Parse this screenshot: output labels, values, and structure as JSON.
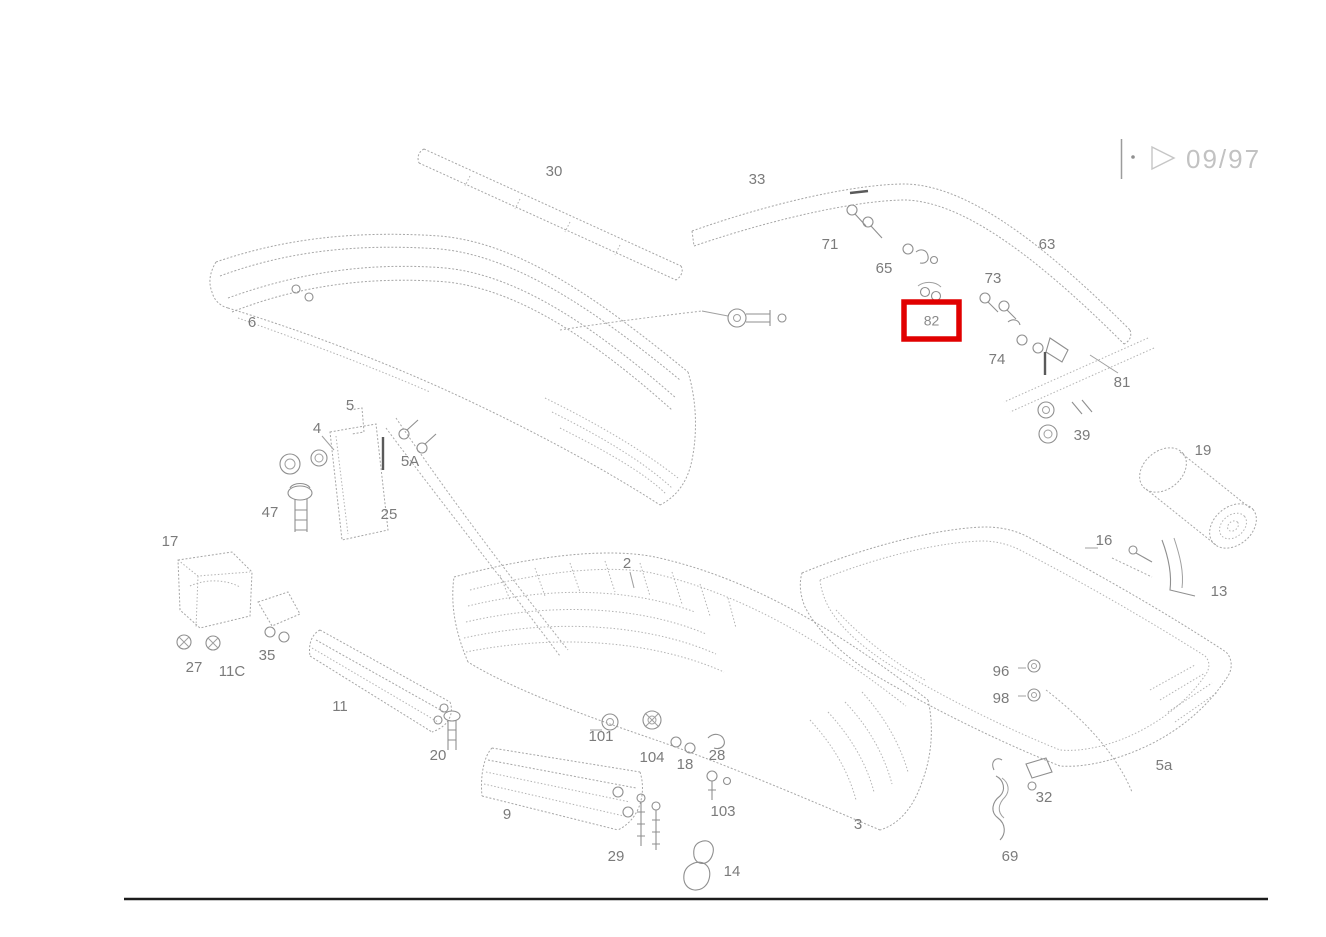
{
  "header": {
    "dot": "·",
    "revision": "09/97"
  },
  "highlight_box": {
    "label": "82",
    "x": 904,
    "y": 302,
    "width": 55,
    "height": 37,
    "color": "#e10000"
  },
  "diagram": {
    "description": "Exploded parts diagram of rear bumper assembly with numbered callouts",
    "labels": [
      {
        "text": "30",
        "x": 554,
        "y": 176
      },
      {
        "text": "33",
        "x": 757,
        "y": 184
      },
      {
        "text": "71",
        "x": 830,
        "y": 249
      },
      {
        "text": "65",
        "x": 884,
        "y": 273
      },
      {
        "text": "63",
        "x": 1047,
        "y": 249
      },
      {
        "text": "73",
        "x": 993,
        "y": 283
      },
      {
        "text": "74",
        "x": 997,
        "y": 364
      },
      {
        "text": "81",
        "x": 1122,
        "y": 387
      },
      {
        "text": "39",
        "x": 1082,
        "y": 440
      },
      {
        "text": "19",
        "x": 1203,
        "y": 455
      },
      {
        "text": "16",
        "x": 1104,
        "y": 545
      },
      {
        "text": "13",
        "x": 1219,
        "y": 596
      },
      {
        "text": "6",
        "x": 252,
        "y": 327
      },
      {
        "text": "4",
        "x": 317,
        "y": 433
      },
      {
        "text": "5",
        "x": 350,
        "y": 410
      },
      {
        "text": "5A",
        "x": 410,
        "y": 466
      },
      {
        "text": "47",
        "x": 270,
        "y": 517
      },
      {
        "text": "25",
        "x": 389,
        "y": 519
      },
      {
        "text": "17",
        "x": 170,
        "y": 546
      },
      {
        "text": "27",
        "x": 194,
        "y": 672
      },
      {
        "text": "11C",
        "x": 232,
        "y": 676
      },
      {
        "text": "35",
        "x": 267,
        "y": 660
      },
      {
        "text": "11",
        "x": 340,
        "y": 711
      },
      {
        "text": "20",
        "x": 438,
        "y": 760
      },
      {
        "text": "2",
        "x": 627,
        "y": 568
      },
      {
        "text": "101",
        "x": 601,
        "y": 741
      },
      {
        "text": "104",
        "x": 652,
        "y": 762
      },
      {
        "text": "18",
        "x": 685,
        "y": 769
      },
      {
        "text": "28",
        "x": 717,
        "y": 760
      },
      {
        "text": "103",
        "x": 723,
        "y": 816
      },
      {
        "text": "9",
        "x": 507,
        "y": 819
      },
      {
        "text": "29",
        "x": 616,
        "y": 861
      },
      {
        "text": "14",
        "x": 732,
        "y": 876
      },
      {
        "text": "3",
        "x": 858,
        "y": 829
      },
      {
        "text": "96",
        "x": 1001,
        "y": 676
      },
      {
        "text": "98",
        "x": 1001,
        "y": 703
      },
      {
        "text": "32",
        "x": 1044,
        "y": 802
      },
      {
        "text": "69",
        "x": 1010,
        "y": 861
      },
      {
        "text": "5a",
        "x": 1164,
        "y": 770
      }
    ]
  },
  "colors": {
    "line": "#a6a6a6",
    "label_text": "#7b7b7b",
    "highlight": "#e10000",
    "bottom_rule": "#1c1c1c",
    "header_text": "#c2c2c2"
  }
}
